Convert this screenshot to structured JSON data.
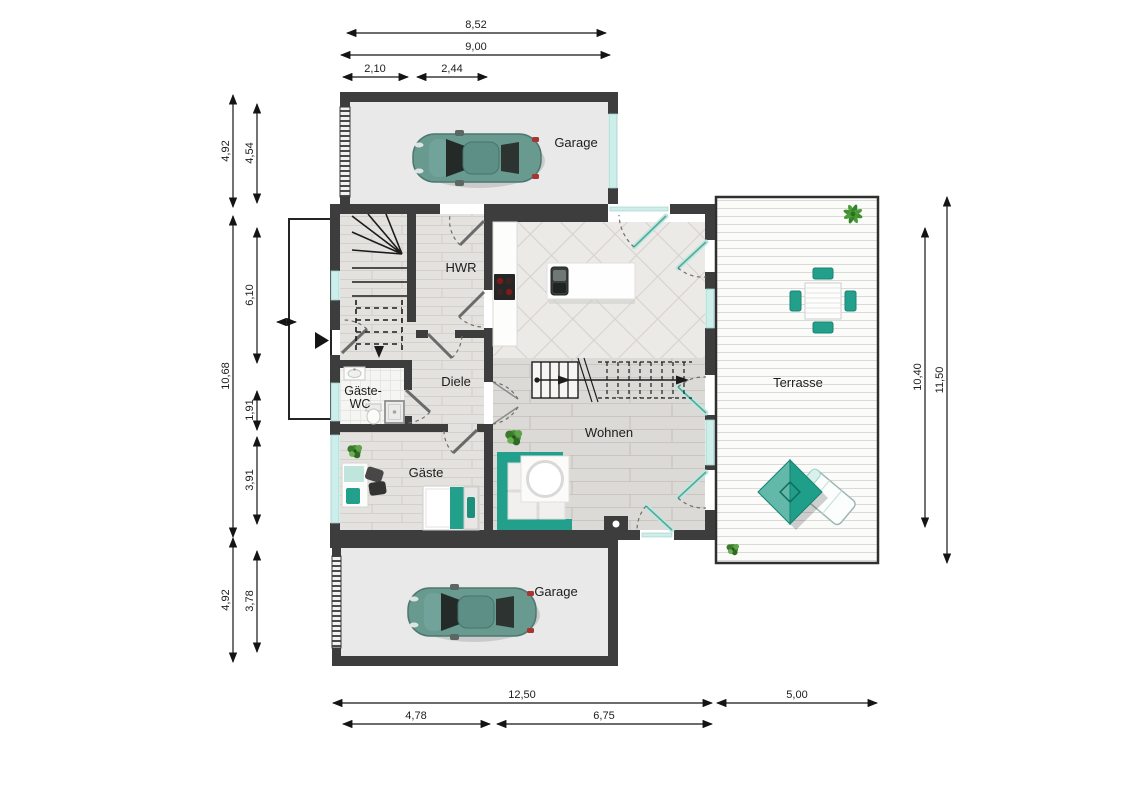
{
  "rooms": {
    "garage_top": "Garage",
    "garage_bottom": "Garage",
    "hwr": "HWR",
    "diele": "Diele",
    "gaeste_wc_line1": "Gäste-",
    "gaeste_wc_line2": "WC",
    "gaeste": "Gäste",
    "wohnen": "Wohnen",
    "terrasse": "Terrasse"
  },
  "dimensions": {
    "top": [
      "8,52",
      "9,00",
      "2,10",
      "2,44"
    ],
    "left": [
      "4,92",
      "4,54",
      "10,68",
      "6,10",
      "1,91",
      "3,91",
      "4,92",
      "3,78"
    ],
    "right": [
      "10,40",
      "11,50"
    ],
    "bottom": [
      "12,50",
      "5,00",
      "4,78",
      "6,75"
    ]
  },
  "colors": {
    "wall": "#3d3d3d",
    "accent_teal": "#23a08c",
    "window_glass": "#cdeeea",
    "garage_floor": "#e9e9e9",
    "car_body": "#689a90"
  }
}
